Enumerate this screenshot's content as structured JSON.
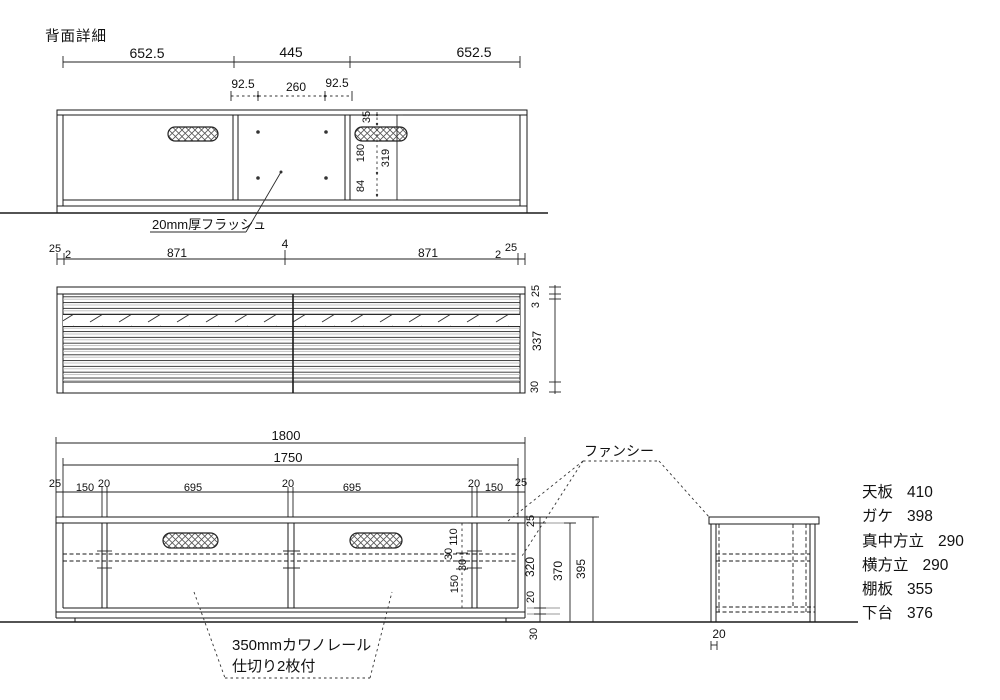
{
  "title": "背面詳細",
  "colors": {
    "line": "#1a1a1a",
    "gray": "#9a9a9a",
    "bg": "#ffffff"
  },
  "back_view": {
    "dim_652_left": "652.5",
    "dim_445": "445",
    "dim_652_right": "652.5",
    "dim_92_left": "92.5",
    "dim_260": "260",
    "dim_92_right": "92.5",
    "dim_35": "35",
    "dim_180": "180",
    "dim_319": "319",
    "dim_84": "84",
    "flush_label": "20mm厚フラッシュ"
  },
  "louver_view": {
    "top_dims": [
      "25",
      "2",
      "871",
      "4",
      "871",
      "2",
      "25"
    ],
    "right_dims": [
      "25",
      "3",
      "337",
      "30"
    ]
  },
  "front_view": {
    "dim_1800": "1800",
    "dim_1750": "1750",
    "row_dims": [
      "25",
      "150",
      "20",
      "695",
      "20",
      "695",
      "20",
      "150",
      "25"
    ],
    "inner_dims": [
      "110",
      "30",
      "30",
      "150"
    ],
    "right_dims": [
      "25",
      "320",
      "20",
      "30",
      "370",
      "395"
    ],
    "fancy_label": "ファンシー",
    "rail_label_line1": "350mmカワノレール",
    "rail_label_line2": "仕切り2枚付"
  },
  "side_view": {
    "dim_20": "20"
  },
  "parts_list": [
    {
      "name": "天板",
      "value": "410"
    },
    {
      "name": "ガケ",
      "value": "398"
    },
    {
      "name": "真中方立",
      "value": "290"
    },
    {
      "name": "横方立",
      "value": "290"
    },
    {
      "name": "棚板",
      "value": "355"
    },
    {
      "name": "下台",
      "value": "376"
    }
  ]
}
